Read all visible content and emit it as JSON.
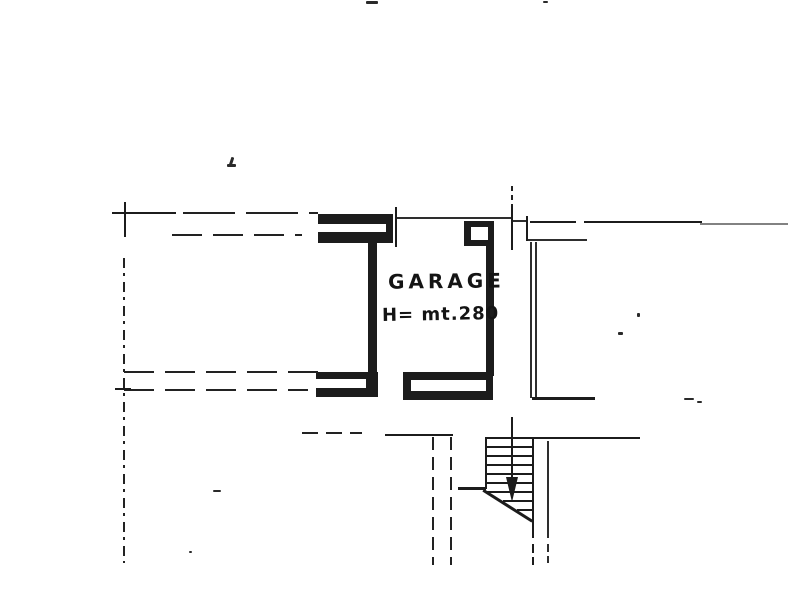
{
  "document": {
    "kind": "scanned cadastral floor plan",
    "paper_color": "#ffffff",
    "ink_color": "#1c1c1c"
  },
  "plan": {
    "room_label": "GARAGE",
    "height_label": "H= mt.280",
    "icons": {
      "stair_arrow": "downward filled arrow marking stair descent"
    }
  }
}
